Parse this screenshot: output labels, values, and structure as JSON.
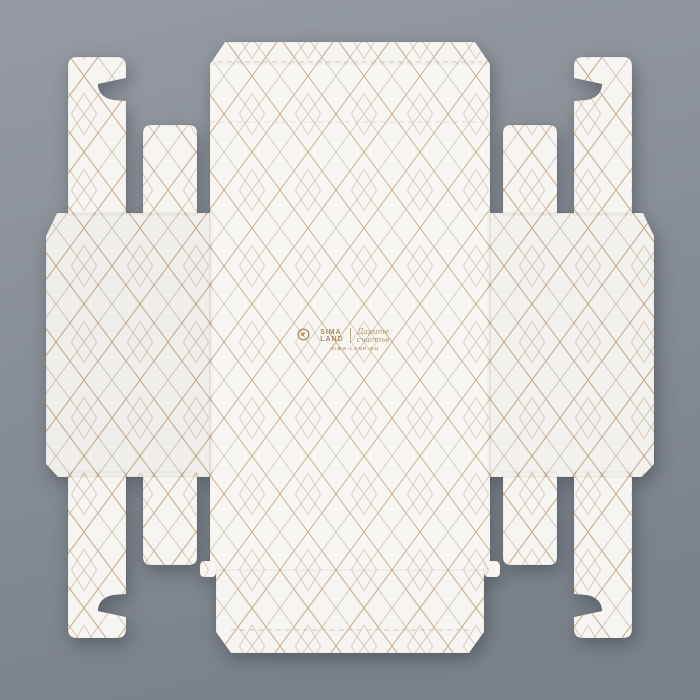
{
  "scene": {
    "description": "Unfolded folding gift-box die-cut blank, white cardboard with gold geometric diamond pattern, photographed flat on a gray surface"
  },
  "colors": {
    "background": "#8a9098",
    "background_light": "#969ba2",
    "background_dark": "#7b828a",
    "cardboard": "#f7f5f1",
    "pattern_gold": "#b6946a",
    "pattern_taupe": "#a79a8b",
    "logo_gold": "#a9895c"
  },
  "logo": {
    "brand_line1": "SIMA",
    "brand_line2": "LAND",
    "tagline_line1": "Дарите",
    "tagline_line2": "счастье",
    "website": "SIMA-LAND.RU"
  }
}
